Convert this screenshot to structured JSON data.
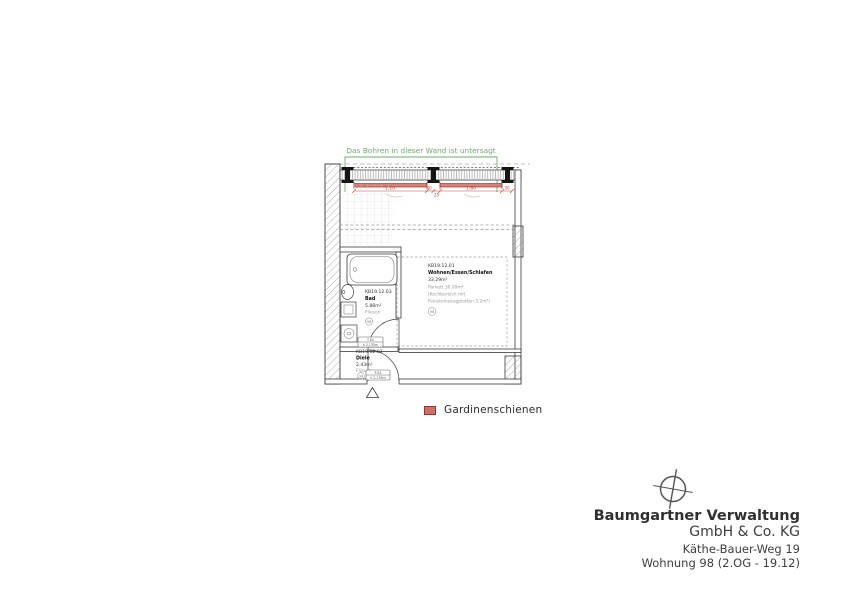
{
  "annotation": {
    "text": "Das Bohren in dieser Wand ist untersagt",
    "color": "#72aa72"
  },
  "legend": {
    "label": "Gardinenschienen",
    "symbol_color": "#cd7066",
    "symbol_border": "#8e362e"
  },
  "title_block": {
    "company": "Baumgartner Verwaltung",
    "company_suffix": "GmbH & Co. KG",
    "address": "Käthe-Bauer-Weg 19",
    "unit": "Wohnung 98 (2.OG - 19.12)"
  },
  "rooms": [
    {
      "id": "KB19.12.01",
      "name": "Wohnen/Essen/Schlafen",
      "area": "33.29m²",
      "floor": "Parkett 30.09m²",
      "note1": "(Kochbereich mit",
      "note2": "Feinsteinzeugplatten 3.2m²)",
      "mark": "98"
    },
    {
      "id": "KB19.12.03",
      "name": "Bad",
      "area": "5.88m²",
      "floor": "Fliesen",
      "mark": "98"
    },
    {
      "id": "KB19.12.02",
      "name": "Diele",
      "area": "2.43m²",
      "floor": "Fliesen",
      "mark": "98"
    }
  ],
  "dimensions": {
    "rail1": "1.10",
    "gap1": "30",
    "gap2": "25",
    "rail2": "1.80",
    "gap3": "30",
    "side": "27"
  },
  "door_tags": [
    {
      "line1": "T.01",
      "line2": "h 2.135m"
    },
    {
      "line1": "T.02",
      "line2": "h 2.135m"
    }
  ],
  "colors": {
    "rail_fill": "#d4837b",
    "rail_stroke": "#a33a31",
    "dim_red": "#bf4a41",
    "wall": "#3a3a3a"
  }
}
